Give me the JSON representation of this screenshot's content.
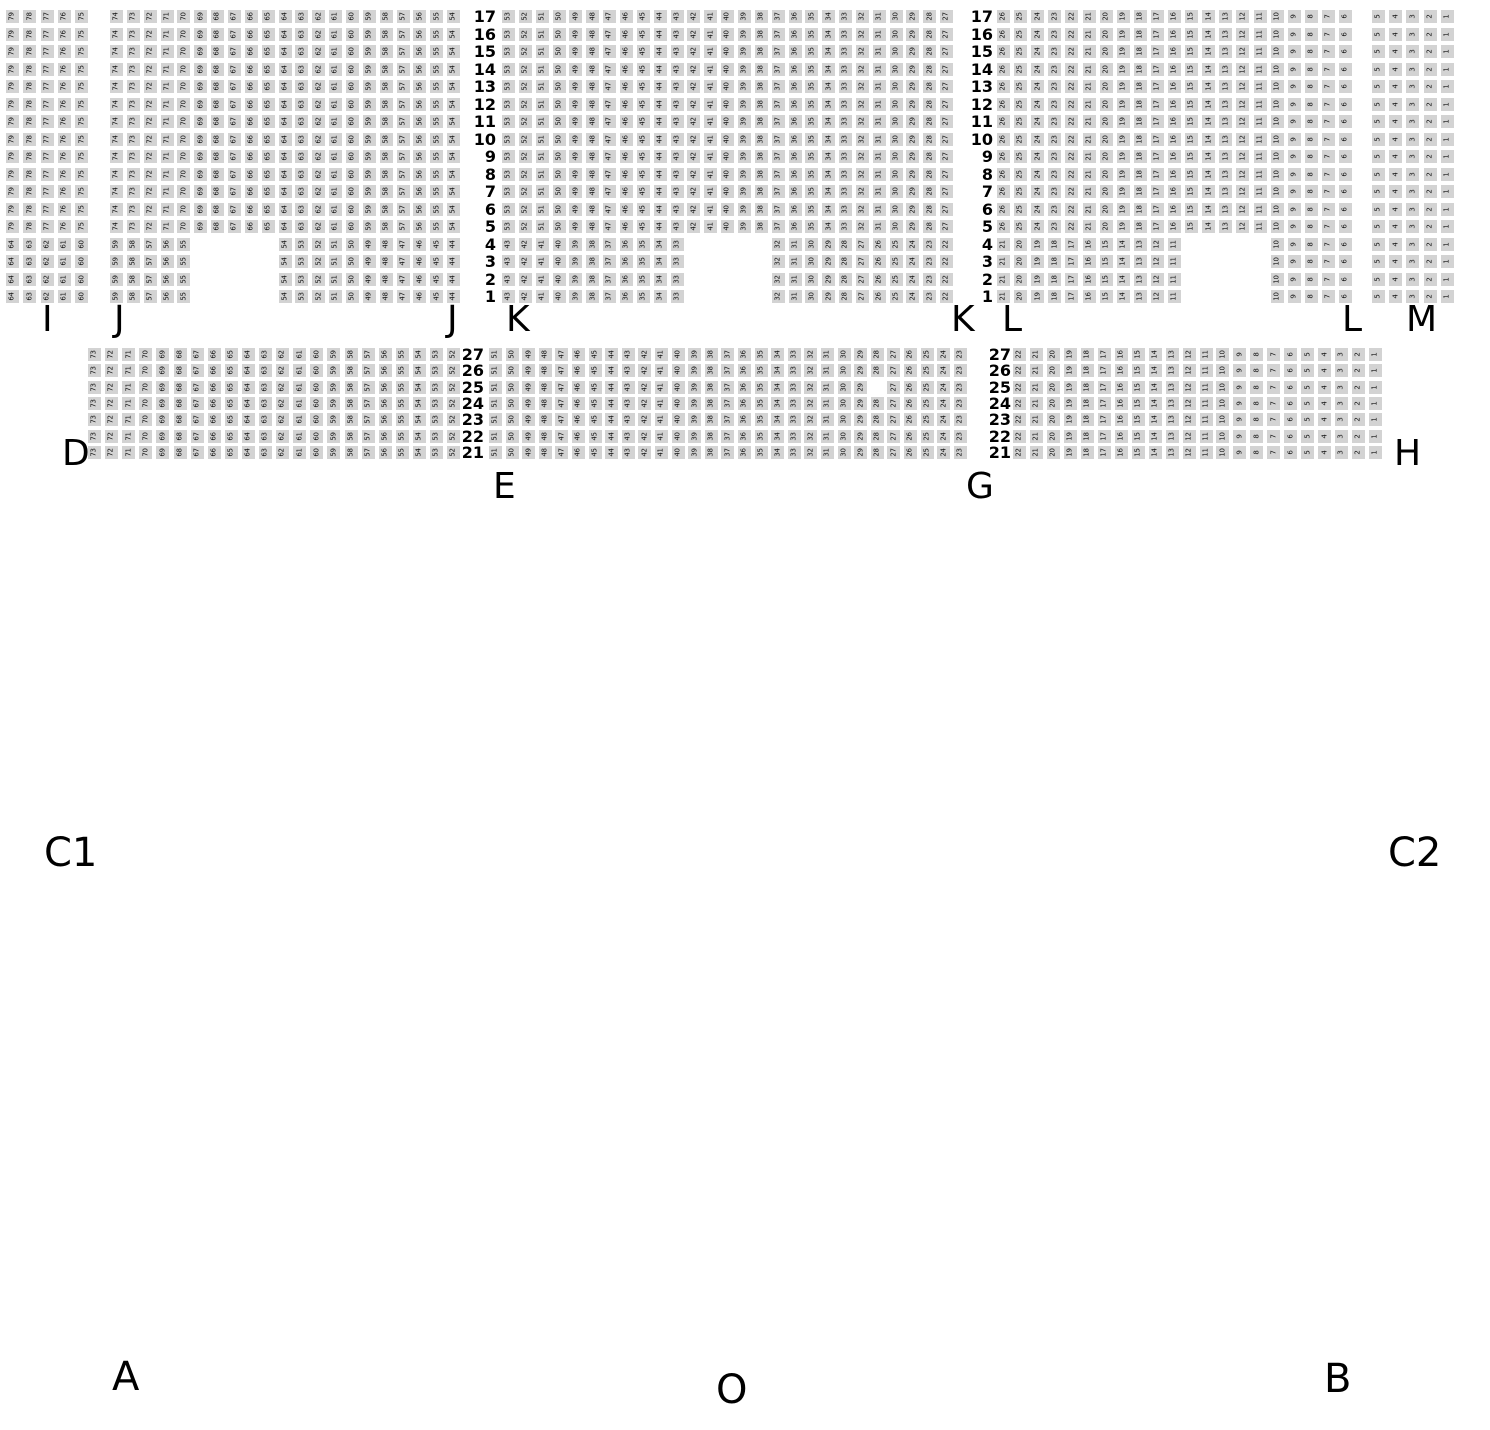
{
  "title": "Venue seating map",
  "colors": {
    "background": "#ffffff",
    "seat_fill": "#d3d3d3",
    "seat_text": "#111111",
    "label_text": "#000000"
  },
  "seat": {
    "size": 13,
    "number_font_px": 7
  },
  "tiers": [
    {
      "name": "upper",
      "y": 10,
      "row_pitch": 17.5,
      "sections": [
        {
          "name": "I",
          "x": 6,
          "pitch": 17.3,
          "row_groups": [
            {
              "repeat": 13,
              "runs": [
                {
                  "col": 0,
                  "from": 79,
                  "to": 75
                }
              ]
            },
            {
              "repeat": 4,
              "runs": [
                {
                  "col": 0,
                  "from": 64,
                  "to": 60
                }
              ]
            }
          ]
        },
        {
          "name": "J",
          "x": 110,
          "pitch": 16.85,
          "row_groups": [
            {
              "repeat": 13,
              "runs": [
                {
                  "col": 0,
                  "from": 74,
                  "to": 54
                }
              ]
            },
            {
              "repeat": 4,
              "runs": [
                {
                  "col": 0,
                  "from": 59,
                  "to": 55
                },
                {
                  "col": 10,
                  "from": 54,
                  "to": 44
                }
              ]
            }
          ]
        },
        {
          "name": "K",
          "x": 502,
          "pitch": 16.85,
          "row_groups": [
            {
              "repeat": 13,
              "runs": [
                {
                  "col": 0,
                  "from": 53,
                  "to": 27
                }
              ]
            },
            {
              "repeat": 4,
              "runs": [
                {
                  "col": 0,
                  "from": 43,
                  "to": 33
                },
                {
                  "col": 16,
                  "from": 32,
                  "to": 22
                }
              ]
            }
          ]
        },
        {
          "name": "L",
          "x": 997,
          "pitch": 17.1,
          "row_groups": [
            {
              "repeat": 13,
              "runs": [
                {
                  "col": 0,
                  "from": 26,
                  "to": 6
                }
              ]
            },
            {
              "repeat": 4,
              "runs": [
                {
                  "col": 0,
                  "from": 21,
                  "to": 11
                },
                {
                  "col": 16,
                  "from": 10,
                  "to": 6
                }
              ]
            }
          ]
        },
        {
          "name": "M",
          "x": 1372,
          "pitch": 17.2,
          "row_groups": [
            {
              "repeat": 17,
              "runs": [
                {
                  "col": 0,
                  "from": 5,
                  "to": 1
                }
              ]
            }
          ]
        }
      ],
      "row_labels": [
        {
          "x_right": 496,
          "values": [
            17,
            16,
            15,
            14,
            13,
            12,
            11,
            10,
            9,
            8,
            7,
            6,
            5,
            4,
            3,
            2,
            1
          ]
        },
        {
          "x_right": 993,
          "values": [
            17,
            16,
            15,
            14,
            13,
            12,
            11,
            10,
            9,
            8,
            7,
            6,
            5,
            4,
            3,
            2,
            1
          ]
        }
      ]
    },
    {
      "name": "lower",
      "y": 348,
      "row_pitch": 16.33,
      "sections": [
        {
          "name": "D",
          "x": 88,
          "pitch": 17.1,
          "row_groups": [
            {
              "repeat": 7,
              "runs": [
                {
                  "col": 0,
                  "from": 73,
                  "to": 52
                }
              ]
            }
          ]
        },
        {
          "name": "E",
          "x": 489,
          "pitch": 16.6,
          "row_groups": [
            {
              "repeat": 2,
              "runs": [
                {
                  "col": 0,
                  "from": 51,
                  "to": 23
                }
              ]
            },
            {
              "repeat": 1,
              "runs": [
                {
                  "col": 0,
                  "from": 51,
                  "to": 29
                },
                {
                  "col": 24,
                  "from": 27,
                  "to": 23
                }
              ]
            },
            {
              "repeat": 4,
              "runs": [
                {
                  "col": 0,
                  "from": 51,
                  "to": 23
                }
              ]
            }
          ]
        },
        {
          "name": "H",
          "x": 1013,
          "pitch": 16.95,
          "row_groups": [
            {
              "repeat": 7,
              "runs": [
                {
                  "col": 0,
                  "from": 22,
                  "to": 1
                }
              ]
            }
          ]
        }
      ],
      "row_labels": [
        {
          "x_right": 484,
          "values": [
            27,
            26,
            25,
            24,
            23,
            22,
            21
          ]
        },
        {
          "x_right": 1011,
          "values": [
            27,
            26,
            25,
            24,
            23,
            22,
            21
          ]
        }
      ]
    }
  ],
  "section_letters": [
    {
      "text": "I",
      "x": 42,
      "y": 302
    },
    {
      "text": "J",
      "x": 114,
      "y": 302
    },
    {
      "text": "J",
      "x": 447,
      "y": 302
    },
    {
      "text": "K",
      "x": 506,
      "y": 302
    },
    {
      "text": "K",
      "x": 951,
      "y": 302
    },
    {
      "text": "L",
      "x": 1002,
      "y": 302
    },
    {
      "text": "L",
      "x": 1342,
      "y": 302
    },
    {
      "text": "M",
      "x": 1406,
      "y": 302
    },
    {
      "text": "D",
      "x": 62,
      "y": 436
    },
    {
      "text": "E",
      "x": 493,
      "y": 469
    },
    {
      "text": "G",
      "x": 966,
      "y": 469
    },
    {
      "text": "H",
      "x": 1394,
      "y": 436
    }
  ],
  "area_letters": [
    {
      "text": "C1",
      "x": 44,
      "y": 833
    },
    {
      "text": "C2",
      "x": 1388,
      "y": 833
    },
    {
      "text": "A",
      "x": 112,
      "y": 1357
    },
    {
      "text": "O",
      "x": 716,
      "y": 1370
    },
    {
      "text": "B",
      "x": 1324,
      "y": 1359
    }
  ]
}
